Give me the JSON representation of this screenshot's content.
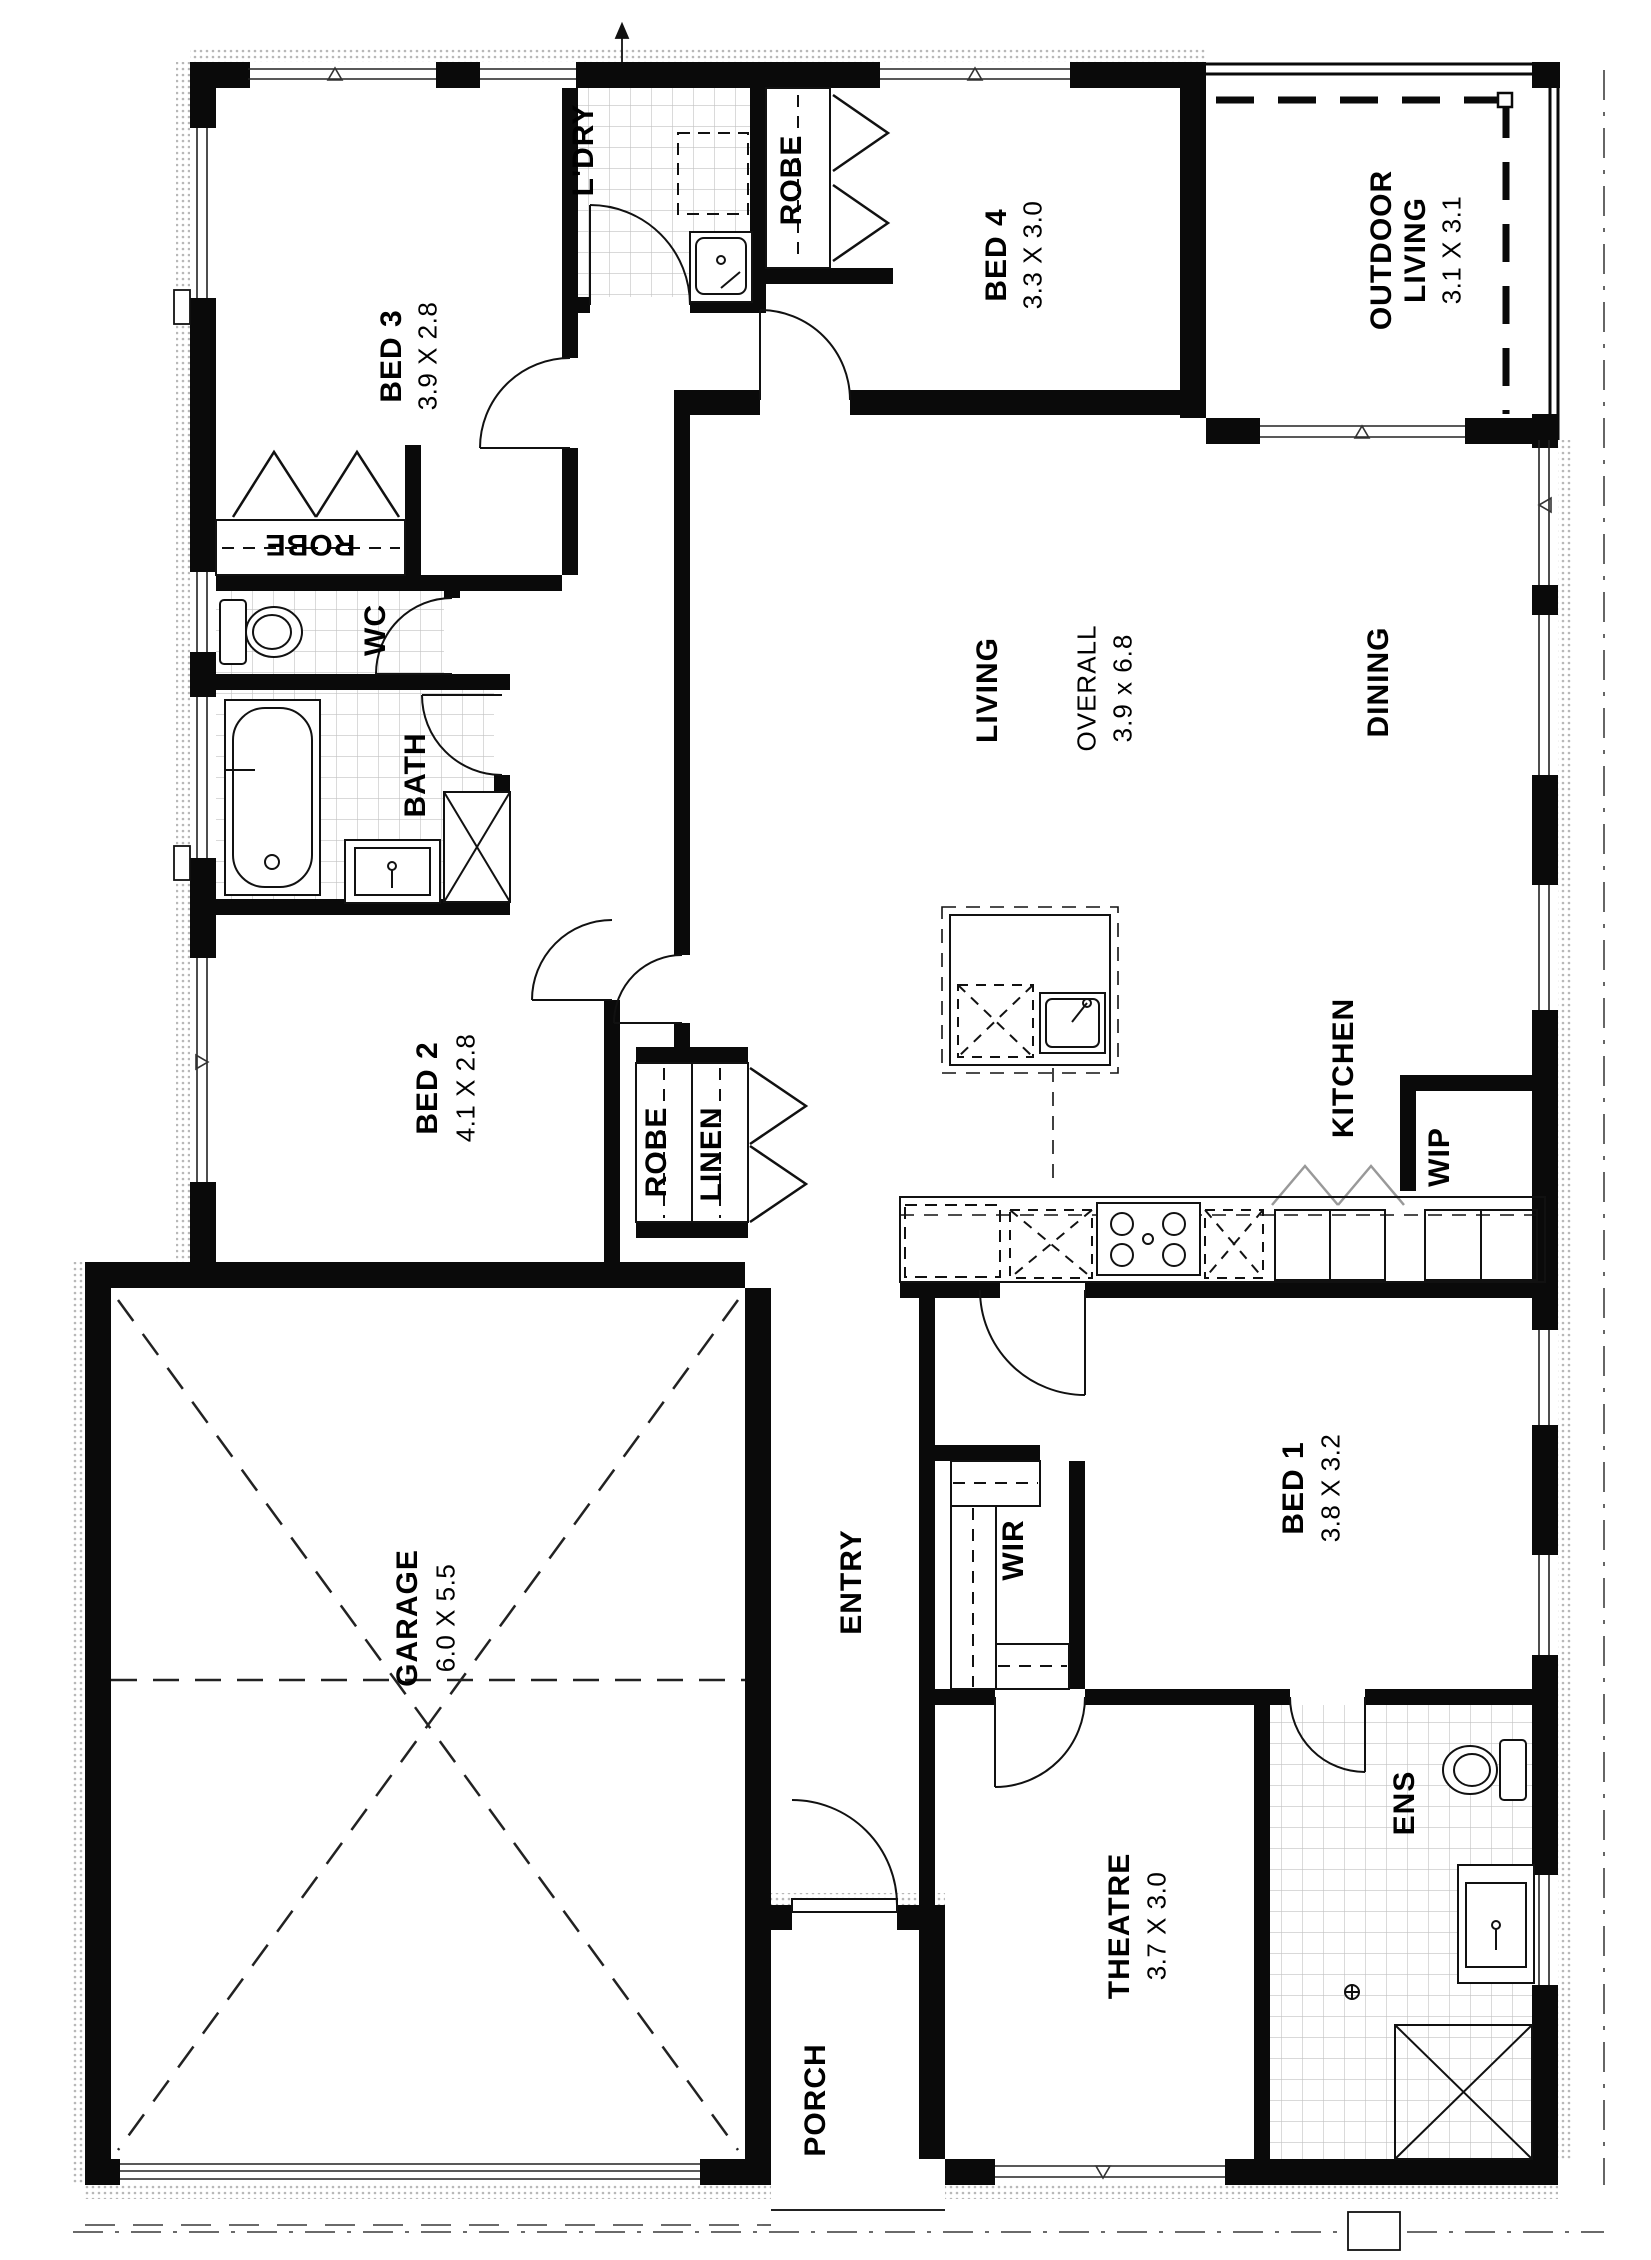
{
  "rooms": {
    "bed3": {
      "name": "BED 3",
      "dims": "3.9 X 2.8"
    },
    "ldry": {
      "name": "L'DRY"
    },
    "robe_bed4": {
      "name": "ROBE"
    },
    "bed4": {
      "name": "BED 4",
      "dims": "3.3 X 3.0"
    },
    "outdoor_living": {
      "line1": "OUTDOOR",
      "line2": "LIVING",
      "dims": "3.1 X 3.1"
    },
    "robe_bed3": {
      "name": "ROBE"
    },
    "wc": {
      "name": "WC"
    },
    "bath": {
      "name": "BATH"
    },
    "living": {
      "name": "LIVING"
    },
    "overall": {
      "name": "OVERALL",
      "dims": "3.9 x 6.8"
    },
    "dining": {
      "name": "DINING"
    },
    "kitchen": {
      "name": "KITCHEN"
    },
    "wip": {
      "name": "WIP"
    },
    "bed2": {
      "name": "BED 2",
      "dims": "4.1 X 2.8"
    },
    "robe_bed2": {
      "name": "ROBE"
    },
    "linen": {
      "name": "LINEN"
    },
    "garage": {
      "name": "GARAGE",
      "dims": "6.0 X 5.5"
    },
    "entry": {
      "name": "ENTRY"
    },
    "wir": {
      "name": "WIR"
    },
    "bed1": {
      "name": "BED 1",
      "dims": "3.8 X 3.2"
    },
    "theatre": {
      "name": "THEATRE",
      "dims": "3.7 X 3.0"
    },
    "ens": {
      "name": "ENS"
    },
    "porch": {
      "name": "PORCH"
    }
  },
  "colors": {
    "wall": "#0a0a0a",
    "tile": "#c2c2c2",
    "stipple": "#b0b0b0",
    "line": "#1a1a1a",
    "gray": "#999999"
  }
}
